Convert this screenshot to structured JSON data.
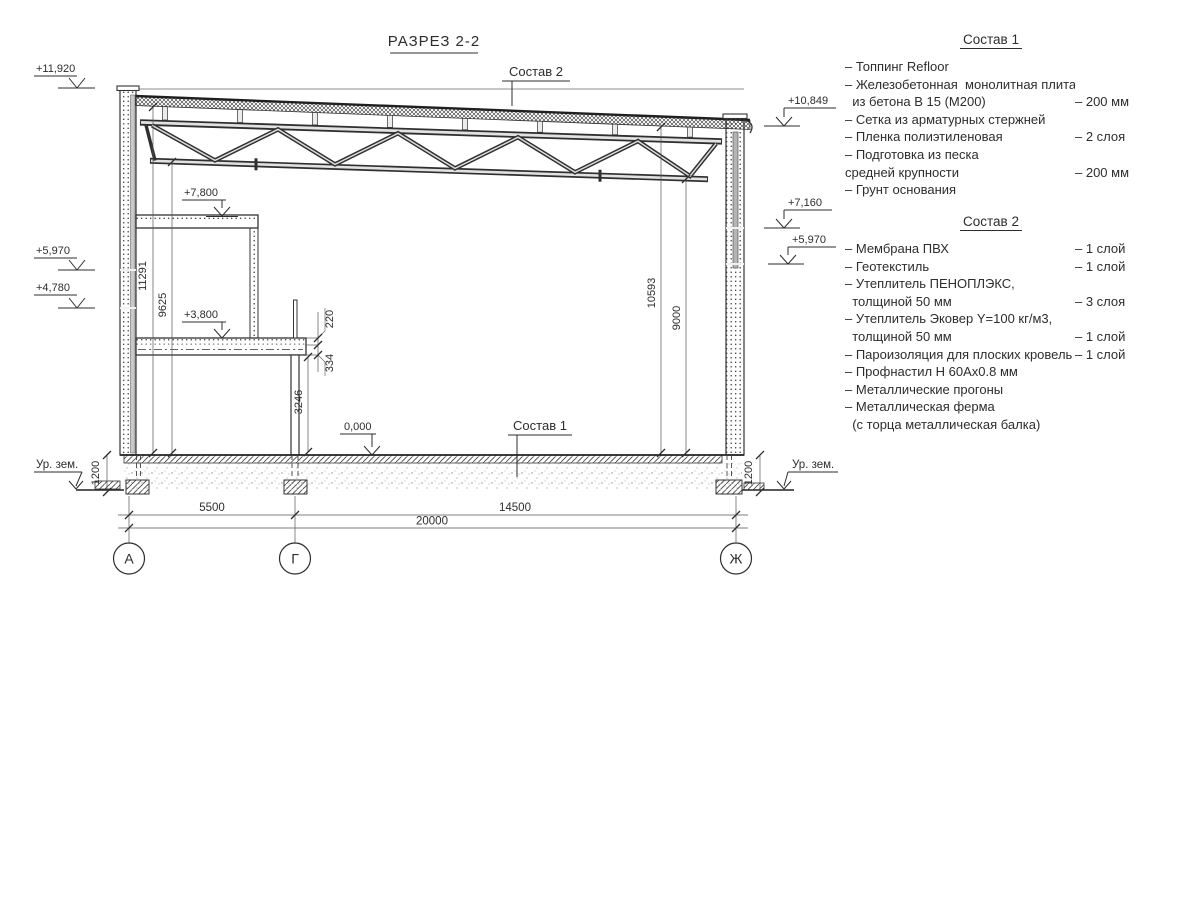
{
  "title": "РАЗРЕЗ 2-2",
  "drawing": {
    "callouts": {
      "sostav2": "Состав 2",
      "sostav1": "Состав 1"
    },
    "elevations": {
      "left_top": "+11,920",
      "left_mid": "+5,970",
      "left_low": "+4,780",
      "mezz_upper": "+7,800",
      "mezz_lower": "+3,800",
      "floor": "0,000",
      "right_top": "+10,849",
      "right_mid": "+7,160",
      "right_low": "+5,970"
    },
    "dims": {
      "h_left_deck": "11291",
      "h_left_chord": "9625",
      "h_right_deck": "10593",
      "h_right_chord": "9000",
      "col_height": "3246",
      "slab": "220",
      "beam": "334",
      "found_left": "1200",
      "found_right": "1200",
      "span_ag": "5500",
      "span_gz": "14500",
      "span_total": "20000"
    },
    "axes": [
      "А",
      "Г",
      "Ж"
    ],
    "ground_left": "Ур. зем.",
    "ground_right": "Ур. зем."
  },
  "notes1": {
    "heading": "Состав 1",
    "rows": [
      {
        "t": "– Топпинг Refloor",
        "v": ""
      },
      {
        "t": "– Железобетонная  монолитная плита",
        "v": ""
      },
      {
        "t": "  из бетона В 15 (М200)",
        "v": "– 200 мм"
      },
      {
        "t": "– Сетка из арматурных стержней",
        "v": ""
      },
      {
        "t": "– Пленка полиэтиленовая",
        "v": "– 2 слоя"
      },
      {
        "t": "– Подготовка из песка",
        "v": ""
      },
      {
        "t": "средней крупности",
        "v": "– 200 мм"
      },
      {
        "t": "– Грунт основания",
        "v": ""
      }
    ]
  },
  "notes2": {
    "heading": "Состав 2",
    "rows": [
      {
        "t": "– Мембрана ПВХ",
        "v": "– 1 слой"
      },
      {
        "t": "– Геотекстиль",
        "v": "– 1 слой"
      },
      {
        "t": "– Утеплитель ПЕНОПЛЭКС,",
        "v": ""
      },
      {
        "t": "  толщиной 50 мм",
        "v": "– 3 слоя"
      },
      {
        "t": "– Утеплитель Эковер Y=100 кг/м3,",
        "v": ""
      },
      {
        "t": "  толщиной 50 мм",
        "v": "– 1 слой"
      },
      {
        "t": "– Пароизоляция для плоских кровель",
        "v": "– 1 слой"
      },
      {
        "t": "– Профнастил Н 60Ах0.8 мм",
        "v": ""
      },
      {
        "t": "– Металлические прогоны",
        "v": ""
      },
      {
        "t": "– Металлическая ферма",
        "v": ""
      },
      {
        "t": "  (с торца металлическая балка)",
        "v": ""
      }
    ]
  }
}
